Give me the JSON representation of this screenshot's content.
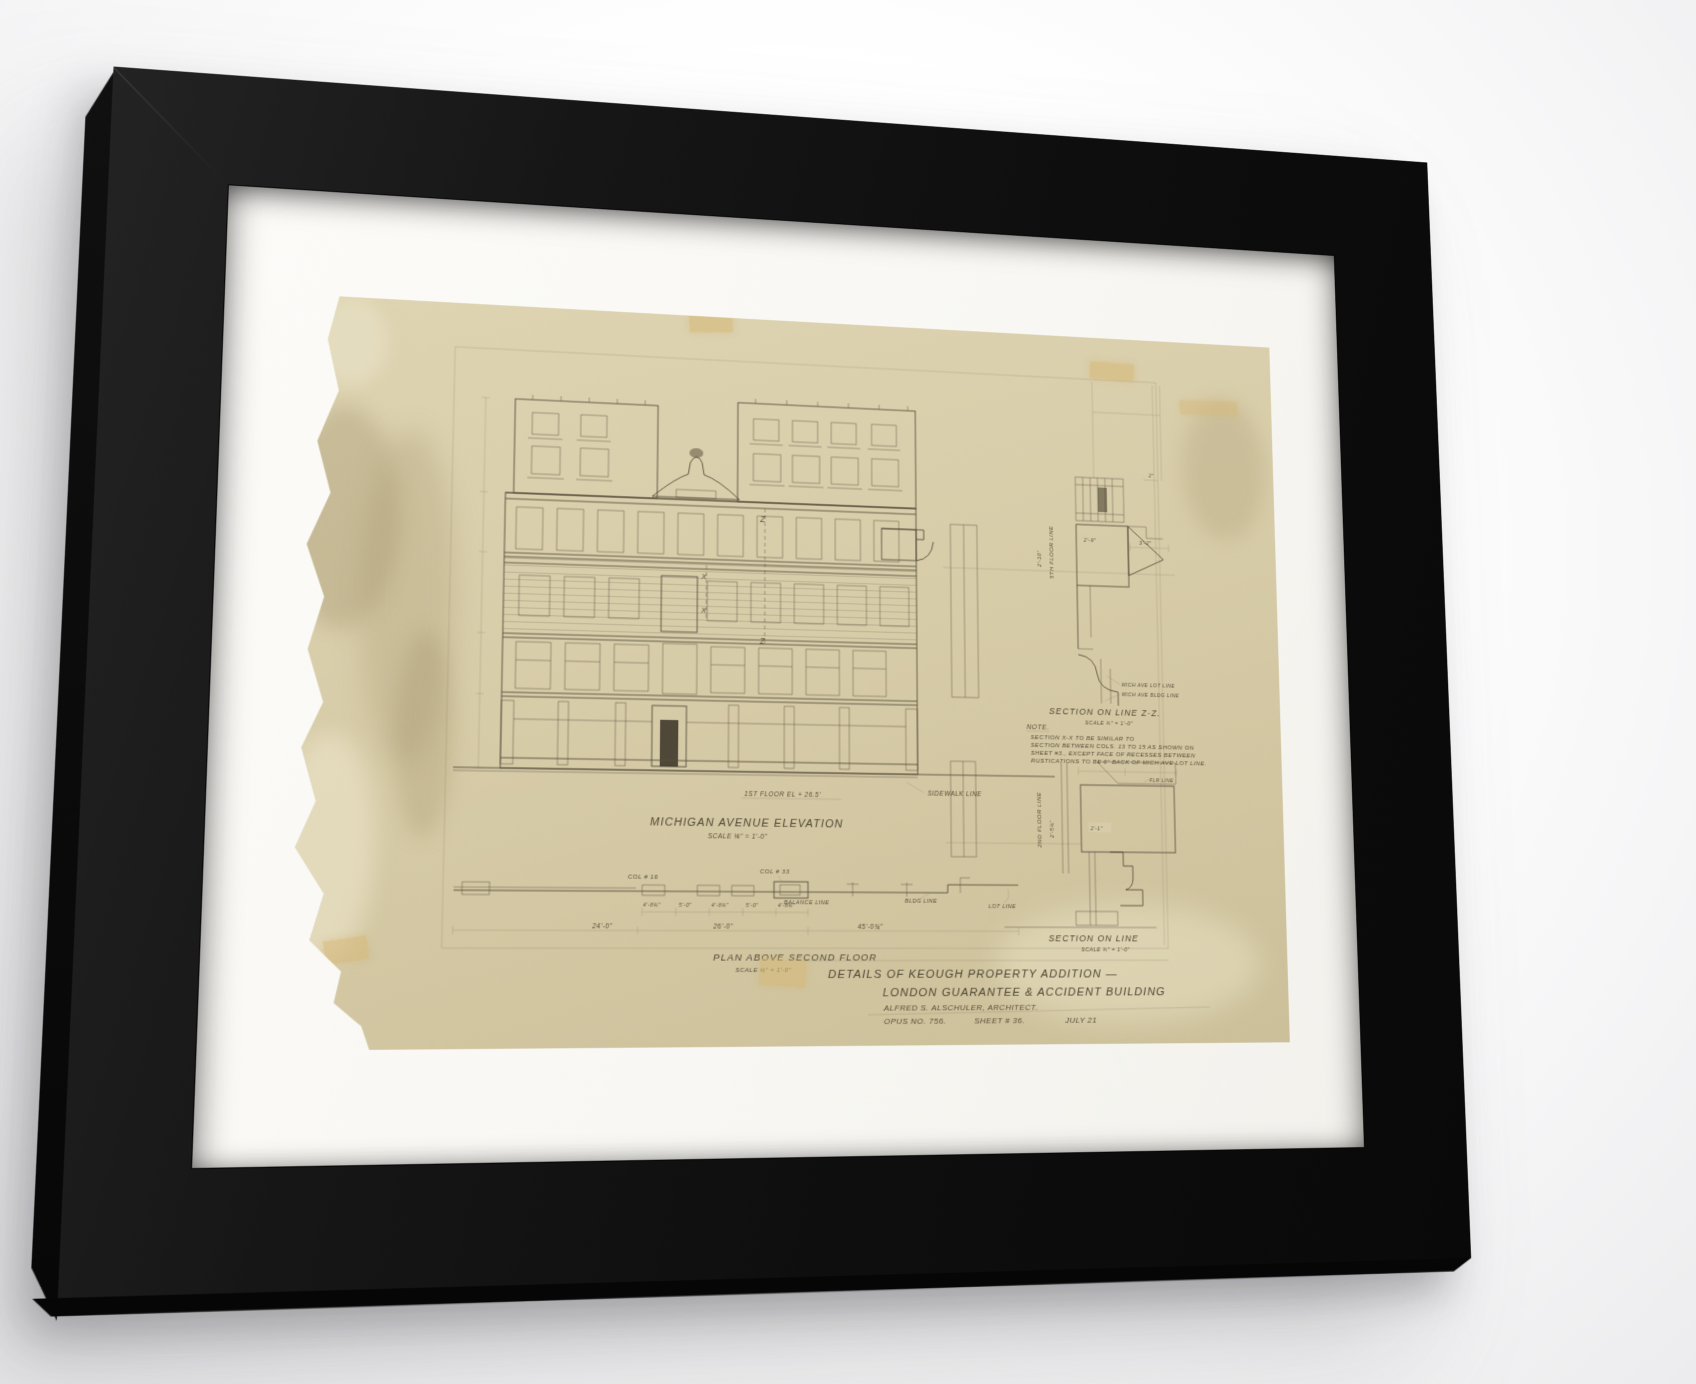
{
  "colors": {
    "frame": "#101010",
    "mat": "#fbfaf7",
    "paper": "#d7cca9",
    "ink": "#5a5040",
    "tape": "#d6b775"
  },
  "art": {
    "elevation": {
      "title": "MICHIGAN AVENUE ELEVATION",
      "scale": "SCALE ⅛\" = 1'-0\"",
      "first_floor_label": "1ST FLOOR EL + 26.5'",
      "sidewalk_label": "SIDEWALK LINE",
      "marker_z": "Z",
      "marker_x": "X"
    },
    "plan": {
      "title": "PLAN ABOVE SECOND FLOOR",
      "scale": "SCALE ⅛\" = 1'-0\"",
      "col16": "COL # 16",
      "col33": "COL # 33",
      "balance_line": "BALANCE LINE",
      "bldg_line": "BLDG LINE",
      "lot_line": "LOT LINE",
      "dims_small": [
        "4'-8¾\"",
        "5'-0\"",
        "4'-8¾\"",
        "5'-0\"",
        "4'-8¾\""
      ],
      "dim_24": "24'-0\"",
      "dim_26": "26'-0\"",
      "dim_45": "45'-0¾\""
    },
    "section_zz": {
      "title": "SECTION ON LINE Z-Z.",
      "scale": "SCALE ¾\" = 1'-0\"",
      "floor_line": "5TH FLOOR LINE",
      "dim_2_10": "2'-10\"",
      "dim_3_2": "3'-2\"",
      "dim_2_9": "2'-9\"",
      "dim_2": "2\"",
      "lot_line": "MICH AVE LOT LINE",
      "bldg_line": "MICH AVE BLDG LINE"
    },
    "note": {
      "heading": "NOTE.",
      "line1": "SECTION X-X TO BE SIMILAR TO",
      "line2": "SECTION BETWEEN COLS. 13 TO 15 AS SHOWN ON",
      "line3": "SHEET #3., EXCEPT FACE OF RECESSES BETWEEN",
      "line4": "RUSTICATIONS TO BE 6\" BACK OF MICH AVE LOT LINE."
    },
    "section_lower": {
      "title": "SECTION ON LINE",
      "scale": "SCALE ¾\" = 1'-0\"",
      "floor_line": "2ND FLOOR LINE",
      "dim_2_5": "2'-5¾\"",
      "dim_2_1": "2'-1\"",
      "flr_line": "FLR LINE"
    },
    "titleblock": {
      "line1": "DETAILS OF KEOUGH PROPERTY ADDITION —",
      "line2": "LONDON GUARANTEE & ACCIDENT BUILDING",
      "architect": "ALFRED S. ALSCHULER, ARCHITECT.",
      "opus": "OPUS NO. 756.",
      "sheet": "SHEET # 36.",
      "date": "JULY 21"
    }
  }
}
